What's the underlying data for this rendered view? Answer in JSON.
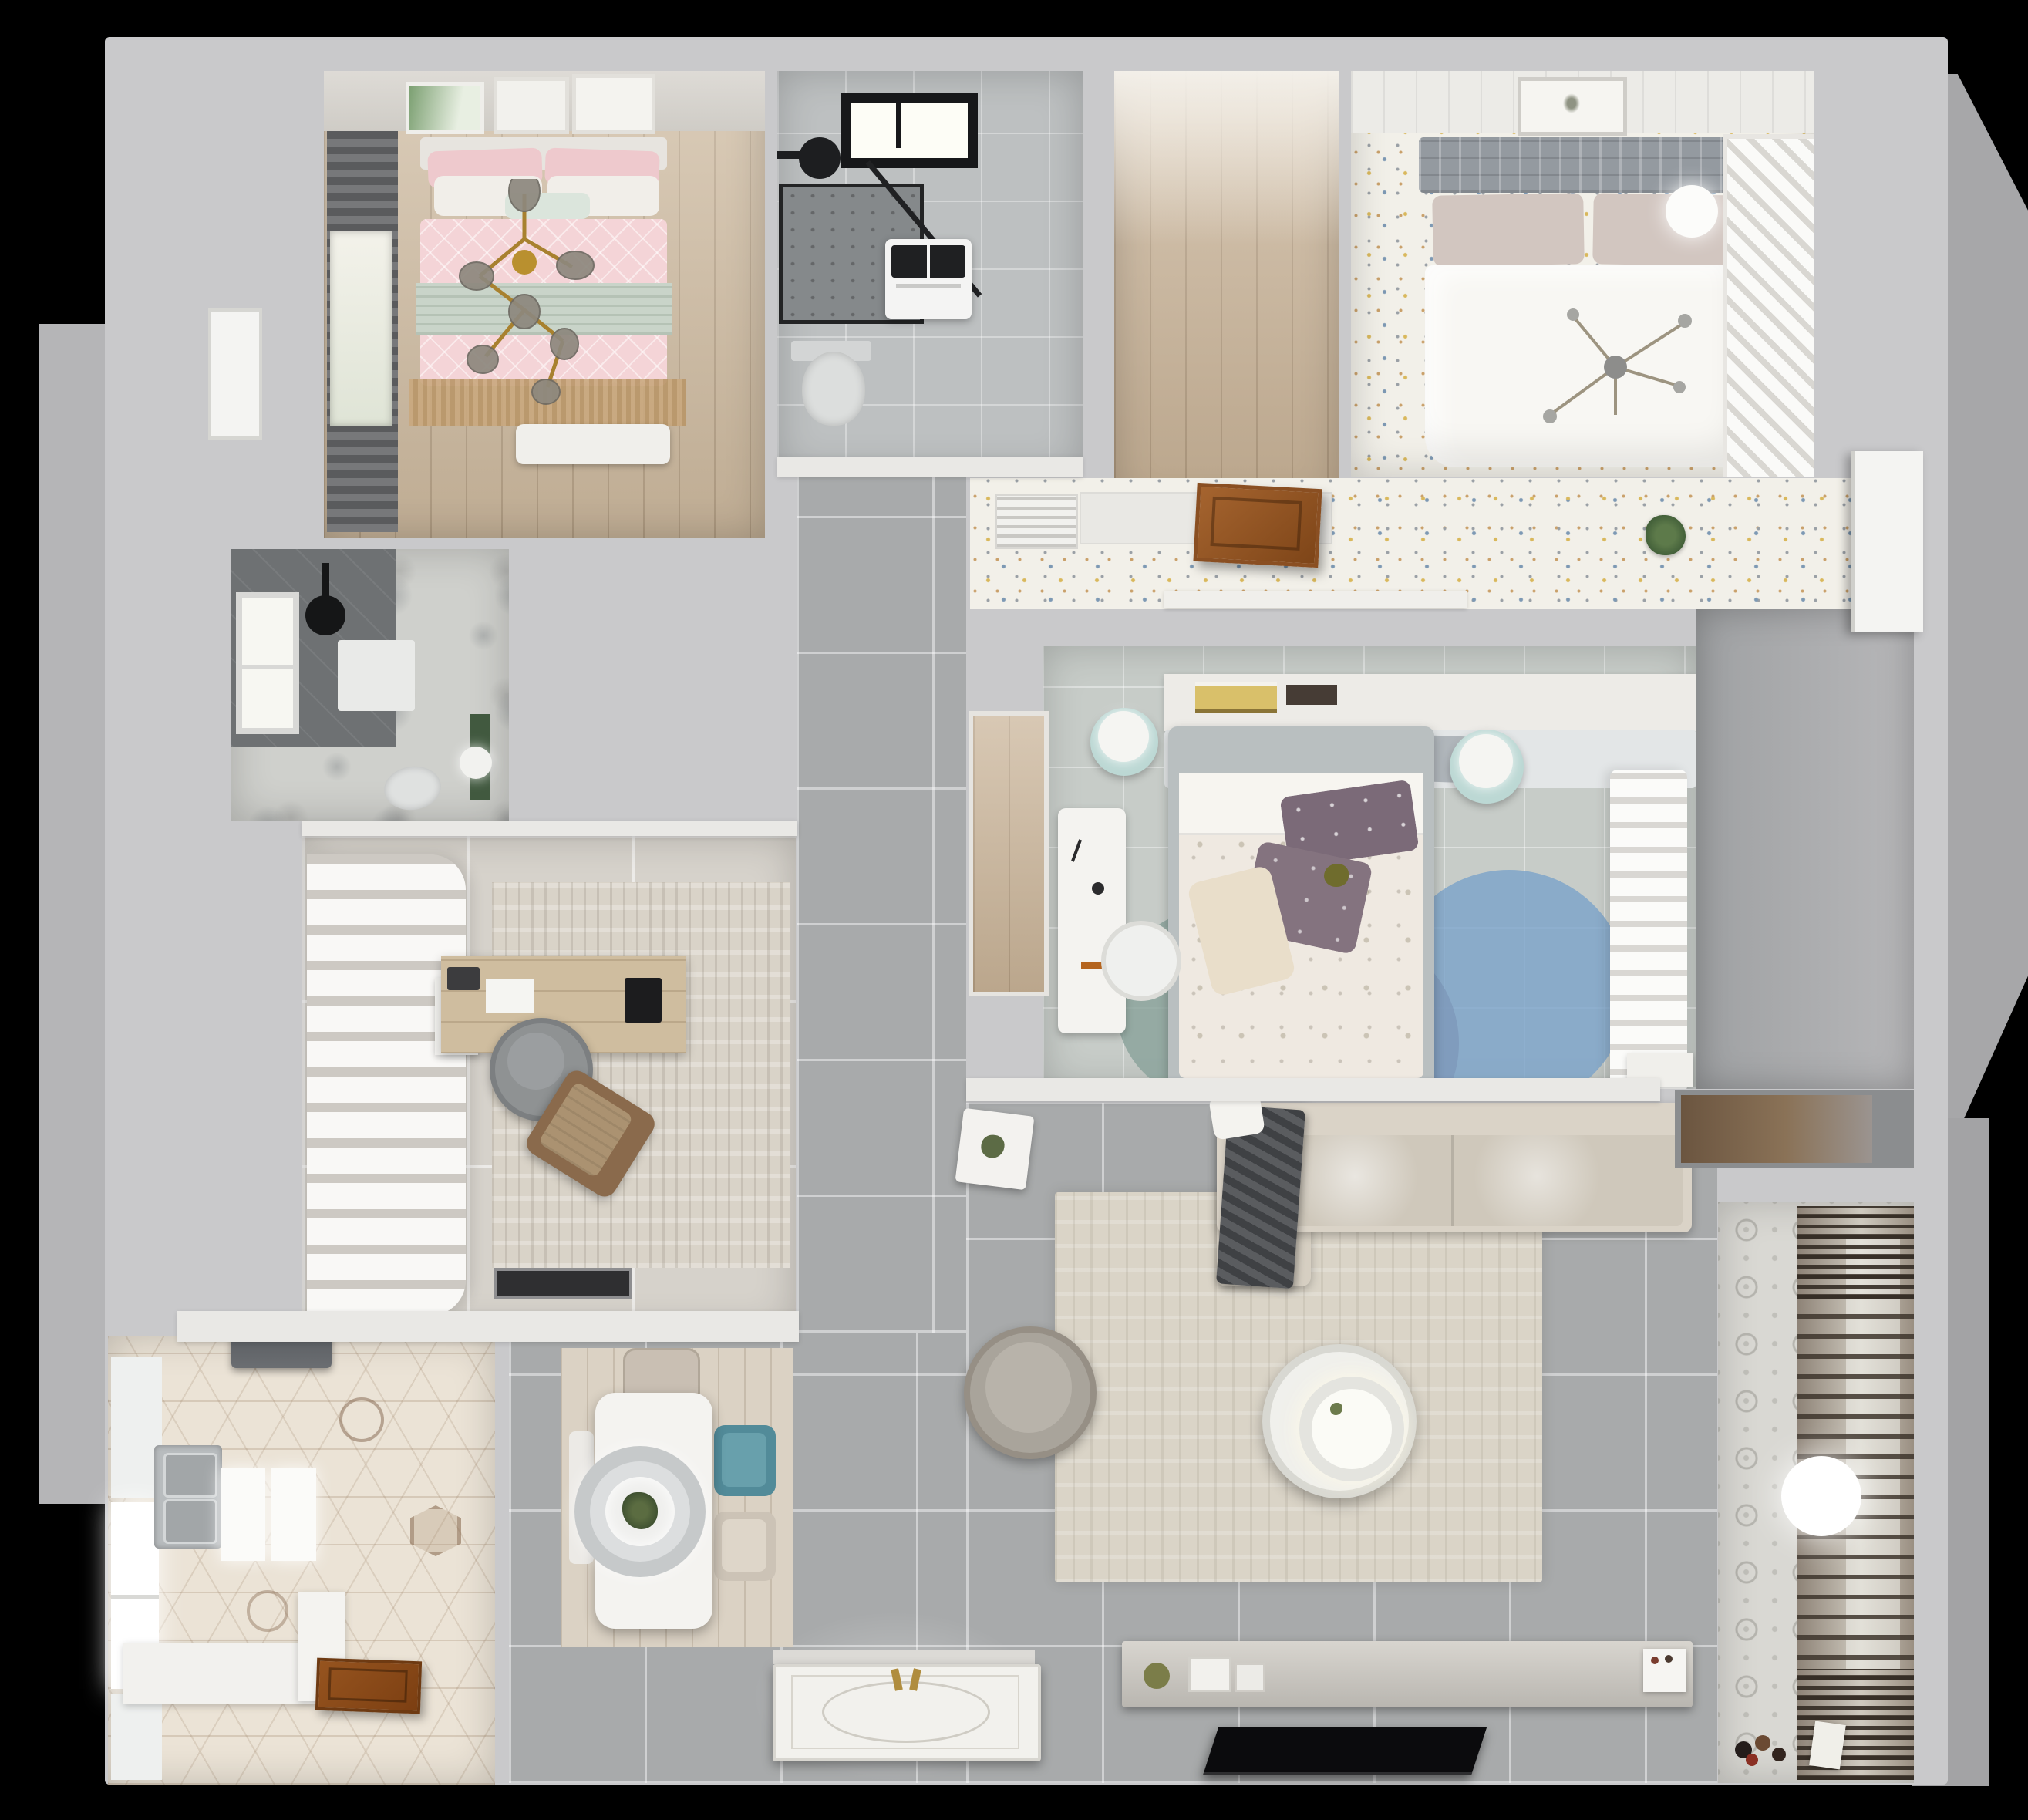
{
  "scene": {
    "title": "Top-down 3D render of a furnished apartment floor plan",
    "background": "#000000",
    "wall_color": "#c9c9cb"
  },
  "palette": {
    "wood": "#cdb99e",
    "oak_light": "#dbd2c4",
    "tile_gray": "#a8aaab",
    "tile_beige": "#d6d2cb",
    "terrazzo_white": "#f2f0e9",
    "hex_tile": "#ebe3d6",
    "pink_duvet": "#f4d4d7",
    "sage_throw": "#c9d4c9",
    "teal_chair": "#528b99",
    "rug_blue": "#7aa3c9",
    "rug_mauve": "#8d7482",
    "rug_teal": "#8aa29b",
    "gold": "#ab8338",
    "charcoal_throw": "#3f4144",
    "door_timber": "#9a5b2a"
  },
  "rooms": {
    "bedroom_pink": {
      "name": "Bedroom with pink bedding",
      "furniture": [
        "double bed",
        "patterned pink duvet",
        "sage green throw",
        "white pillows",
        "gold branch chandelier",
        "three wall art frames",
        "roman blind window",
        "fringed tan rug",
        "white bench"
      ]
    },
    "bathroom_main": {
      "name": "Main bathroom",
      "furniture": [
        "skylight window",
        "black rain shower",
        "glass shower enclosure",
        "washing machine",
        "wall-hung toilet"
      ]
    },
    "closet_walkin": {
      "name": "Empty walk-in closet",
      "furniture": [
        "oak plank floor"
      ]
    },
    "bedroom_master": {
      "name": "Master bedroom",
      "furniture": [
        "panelled feature wall",
        "framed artwork",
        "grey upholstered headboard",
        "double bed with white duvet",
        "sphere pendant lamp",
        "branch chandelier",
        "slatted white wardrobe",
        "confetti terrazzo floor"
      ]
    },
    "dressing_area": {
      "name": "Dressing corridor",
      "furniture": [
        "air-conditioning grille",
        "open timber door",
        "white sideboard",
        "potted plant",
        "display ledge"
      ]
    },
    "bathroom_guest": {
      "name": "Guest shower room",
      "furniture": [
        "dark tiled shower",
        "black rain shower",
        "bright window",
        "white shower mat",
        "toilet",
        "green storage unit",
        "sphere lamp"
      ]
    },
    "study": {
      "name": "Home office",
      "furniture": [
        "sheer drape wall",
        "timber desk",
        "monitor",
        "round desk chair",
        "tan lounge chair",
        "textured rug",
        "dark doormat"
      ]
    },
    "corridor": {
      "name": "Central hallway",
      "furniture": [
        "large grey porcelain tiles"
      ]
    },
    "kitchen": {
      "name": "Kitchen",
      "furniture": [
        "range hood",
        "double stainless sink",
        "bright window",
        "island worktops",
        "white base cabinets",
        "open timber door",
        "hexagon tile floor"
      ]
    },
    "dining": {
      "name": "Dining area",
      "furniture": [
        "white dining table",
        "ring pendant light",
        "centrepiece plant",
        "beige chair",
        "teal chair",
        "second beige chair",
        "white bench",
        "oak plank mat"
      ]
    },
    "living": {
      "name": "Living room",
      "furniture": [
        "corner sofa",
        "charcoal throw",
        "white scatter cushion",
        "round armchair",
        "white side table",
        "round coffee table with lamp",
        "large beige rug",
        "TV sideboard",
        "flat-screen TV",
        "decor objects"
      ]
    },
    "bedroom_kids": {
      "name": "Second bedroom",
      "furniture": [
        "headboard shelf with books",
        "bed with floral duvet",
        "plum pillows",
        "cream pillow",
        "two mint poufs with lamps",
        "white desk",
        "white chair",
        "overlapping circle rug",
        "sheer curtain",
        "closet niche",
        "nightstand"
      ]
    },
    "hallway_right": {
      "name": "Rear hallway",
      "furniture": [
        "open white door",
        "storage niche with timber shelf"
      ]
    },
    "laundry": {
      "name": "Drying balcony / laundry",
      "furniture": [
        "towel drying rack",
        "bright window",
        "sphere floor lamp",
        "patterned cement tiles",
        "toys on floor"
      ]
    },
    "entry": {
      "name": "Entrance",
      "furniture": [
        "ornate entry door with gold handles"
      ]
    }
  }
}
